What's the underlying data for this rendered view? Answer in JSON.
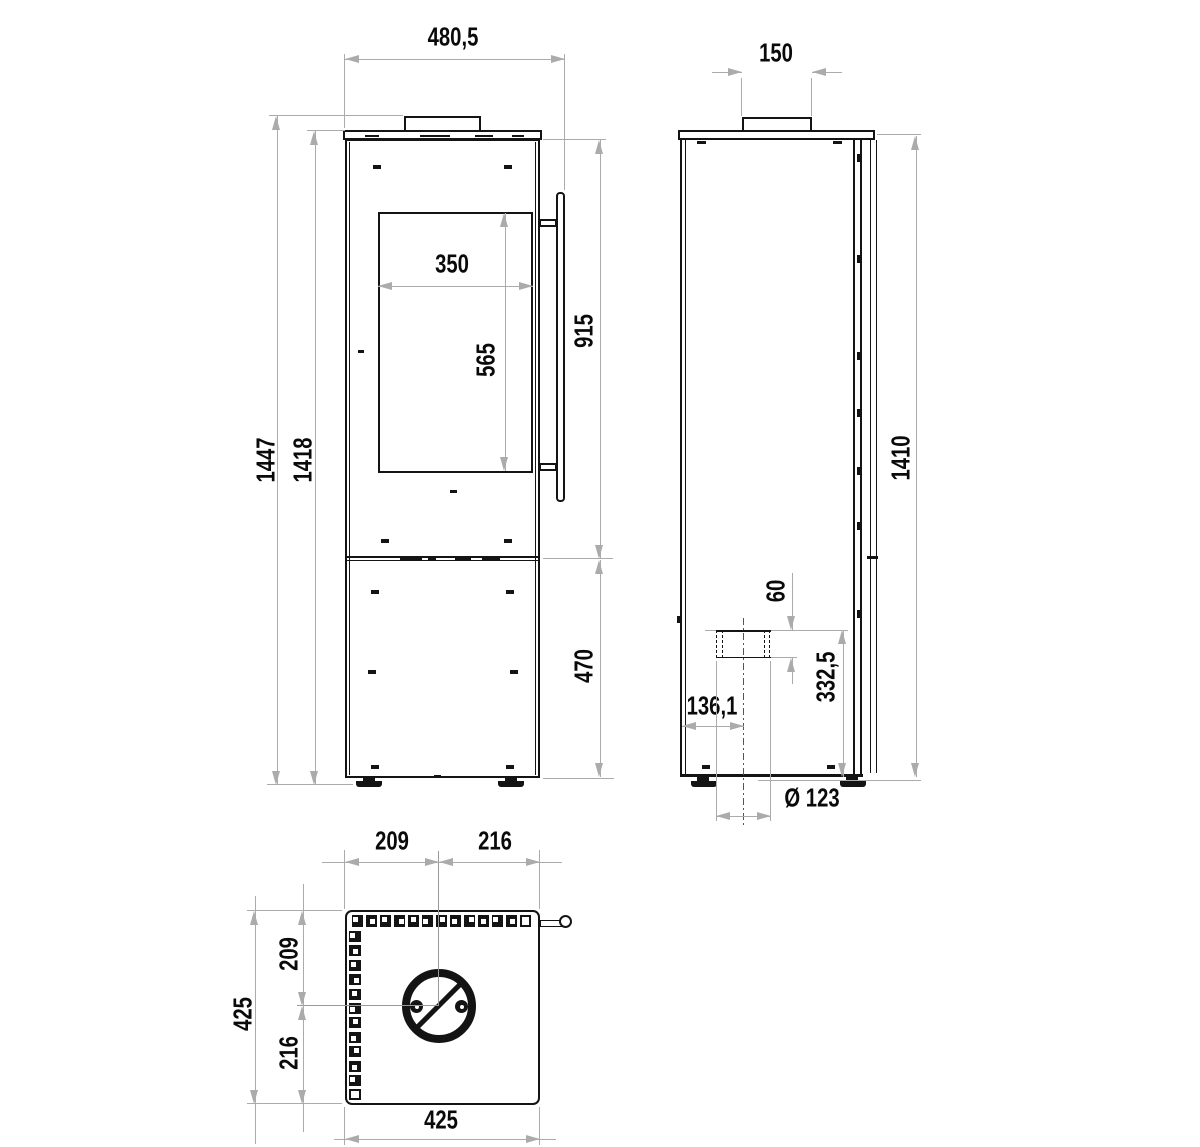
{
  "dims": {
    "front_overall_width": "480,5",
    "front_total_height": "1447",
    "front_body_height": "1418",
    "glass_width": "350",
    "glass_height": "565",
    "door_section_height": "915",
    "base_section_height": "470",
    "flue_collar_width": "150",
    "side_height": "1410",
    "air_inlet_height": "60",
    "air_inlet_center_height": "332,5",
    "air_inlet_offset": "136,1",
    "air_inlet_diameter": "Ø 123",
    "plan_top_left": "209",
    "plan_top_right": "216",
    "plan_left_upper": "209",
    "plan_left_lower": "216",
    "plan_left_total": "425",
    "plan_bottom_width": "425"
  },
  "plan_view": {
    "vent_top_count": 13,
    "vent_left_count": 12
  },
  "line_colors": {
    "object": "#141414",
    "dimension": "#ababab",
    "centerline": "#999999"
  }
}
